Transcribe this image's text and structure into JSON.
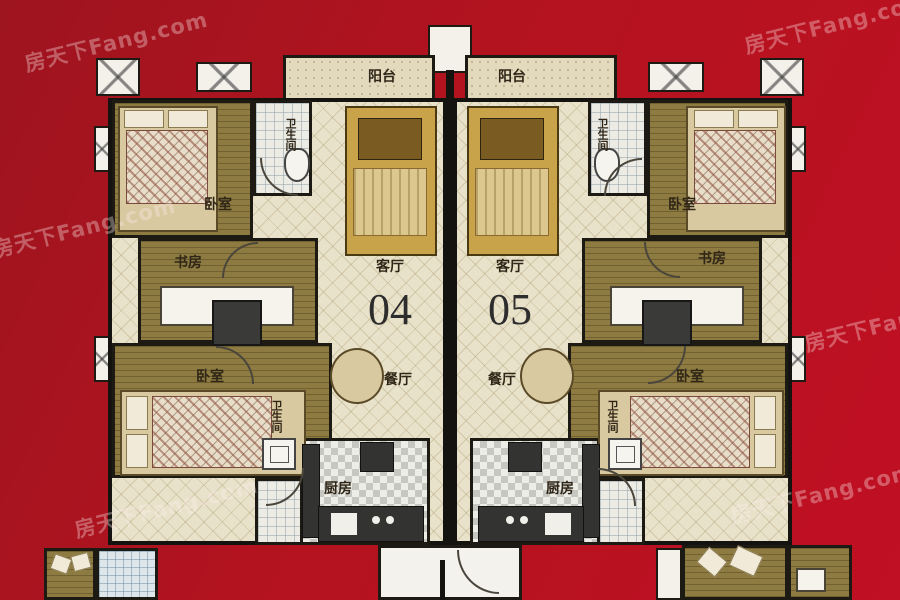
{
  "watermark": {
    "text": "房天下Fang.com"
  },
  "labels": {
    "balcony": "阳台",
    "bedroom": "卧室",
    "study": "书房",
    "living_room": "客厅",
    "dining_room": "餐厅",
    "kitchen": "厨房",
    "bathroom": "卫生间"
  },
  "units": [
    {
      "number": "04"
    },
    {
      "number": "05"
    }
  ],
  "colors": {
    "background_red": "#b3131f",
    "floor_cream": "#e9e2ca",
    "floor_wood": "#8d7b41",
    "wall": "#15130f",
    "furniture_gold": "#c8a34a"
  }
}
